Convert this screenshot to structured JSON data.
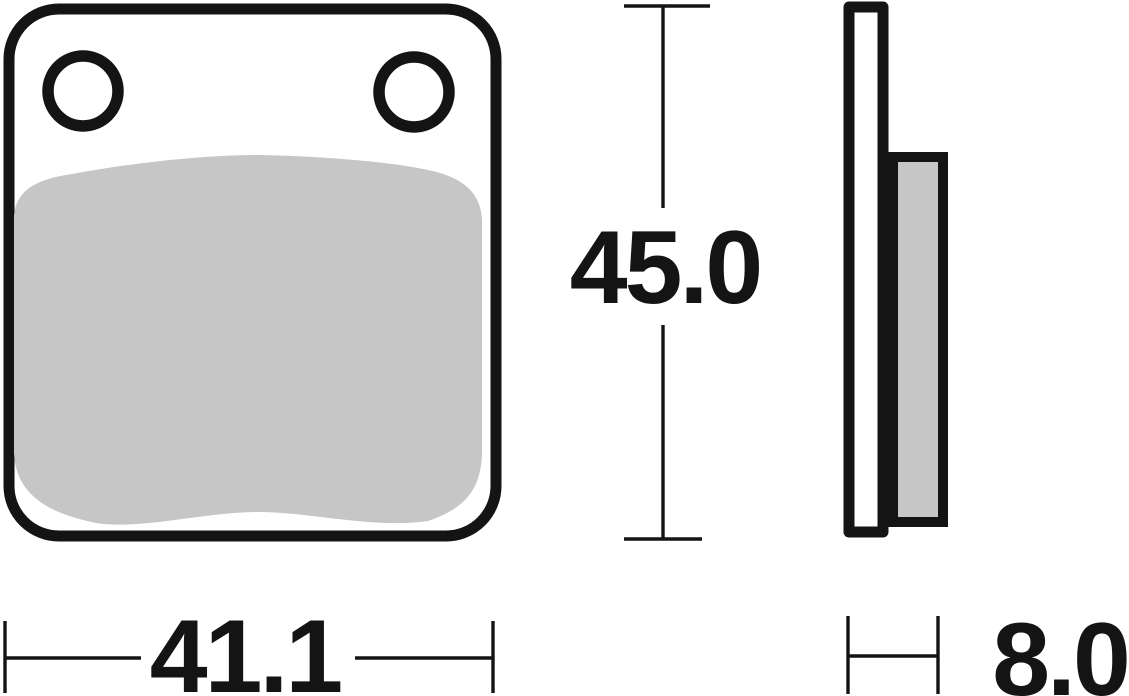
{
  "dimensions": {
    "height_label": "45.0",
    "width_label": "41.1",
    "thickness_label": "8.0"
  },
  "colors": {
    "outline": "#141414",
    "friction_material": "#c6c6c6",
    "background": "#ffffff"
  }
}
